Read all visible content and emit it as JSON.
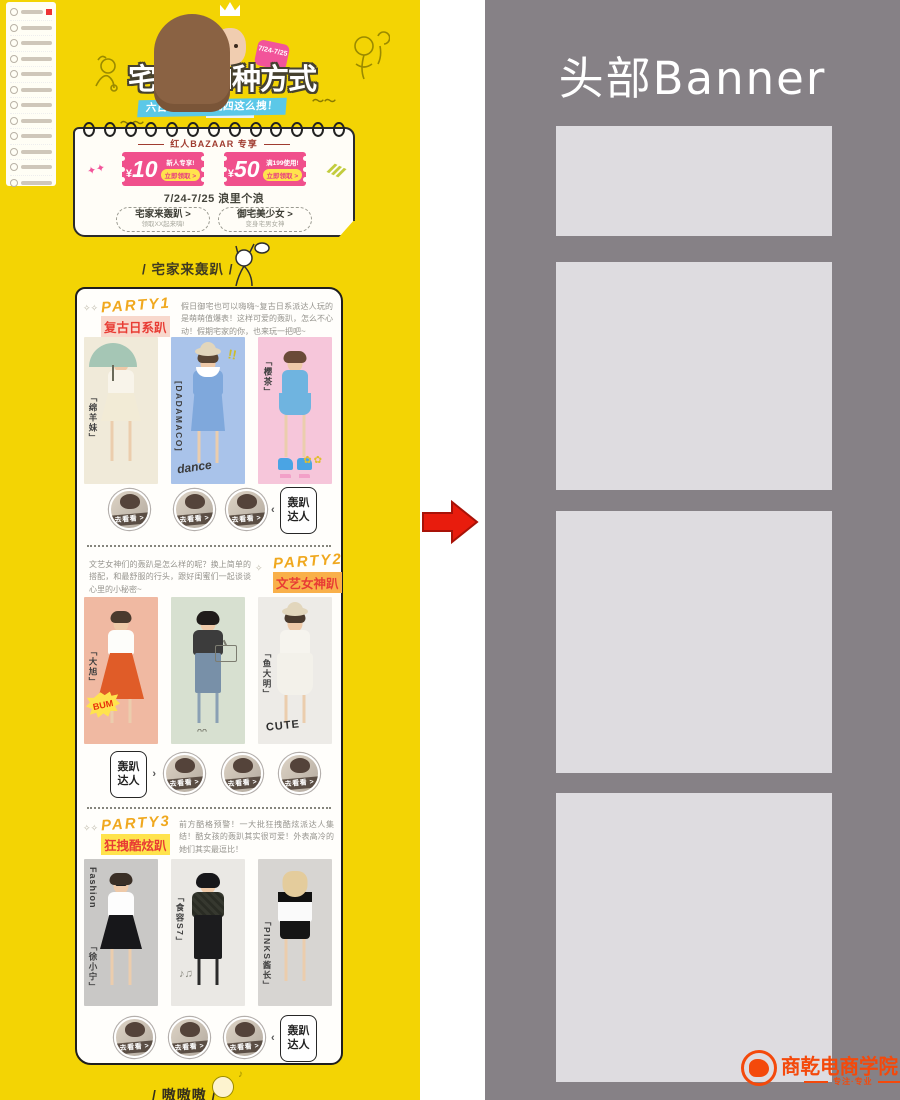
{
  "page": {
    "header": {
      "badge": "7/24-7/25",
      "title": "宅家のN种方式",
      "subtitle": "六日狂欢宅，就四这么拽！"
    },
    "coupon_panel": {
      "title": "红人BAZAAR 专享",
      "coupons": [
        {
          "currency": "¥",
          "amount": "10",
          "condition": "新人专享!",
          "action": "立即领取 >"
        },
        {
          "currency": "¥",
          "amount": "50",
          "condition": "满199使用!",
          "action": "立即领取 >"
        }
      ],
      "date_line": "7/24-7/25 浪里个浪",
      "nav_buttons": [
        {
          "label": "宅家来轰趴 >",
          "sub": "领取XX起来嗨!"
        },
        {
          "label": "御宅美少女 >",
          "sub": "变身宅男女神"
        }
      ]
    },
    "section_title": "/ 宅家来轰趴 /",
    "go_label": "去看看 >",
    "expert_label": "轰趴达人",
    "parties": [
      {
        "tag": "PARTY1",
        "name": "复古日系趴",
        "desc": "假日御宅也可以嗨嗨~复古日系派达人玩的是萌萌值爆表！这样可爱的轰趴，怎么不心动！假期宅家的你，也来玩一把吧~",
        "models": [
          {
            "label": "「绵羊妹」",
            "bg": "#f0ead9"
          },
          {
            "label": "[DADAMACO]",
            "bg": "#a9c3ea",
            "extra": "dance"
          },
          {
            "label": "「樱茶」",
            "bg": "#f6c6da"
          }
        ]
      },
      {
        "tag": "PARTY2",
        "name": "文艺女神趴",
        "desc": "文艺女神们的轰趴是怎么样的呢？换上简单的搭配，和最舒服的行头，跟好闺蜜们一起谈谈心里的小秘密~",
        "models": [
          {
            "label": "「大旭」",
            "bg": "#f0b9a2",
            "extra": "BUM"
          },
          {
            "label": "「蛋挞」",
            "bg": "#d7e0d0"
          },
          {
            "label": "「鱼大明」",
            "bg": "#edebe7",
            "extra": "CUTE"
          }
        ]
      },
      {
        "tag": "PARTY3",
        "name": "狂拽酷炫趴",
        "desc": "前方酷格预警！一大批狂拽酷炫派达人集结！酷女孩的轰趴其实很可爱！外表高冷的她们其实最逗比！",
        "models": [
          {
            "label": "「徐小宁」",
            "bg": "#c9c8c6",
            "extra": "Fashion"
          },
          {
            "label": "「食容S7」",
            "bg": "#eae8e4"
          },
          {
            "label": "「PINKS酱长」",
            "bg": "#d7d5d2"
          }
        ]
      }
    ],
    "next_section_title": "/ 嗷嗷嗷 /"
  },
  "wireframe": {
    "title": "头部Banner"
  },
  "watermark": {
    "name": "商乾电商学院",
    "tagline": "专注·专业"
  },
  "colors": {
    "page_yellow": "#f3d404",
    "panel_gray": "#868186",
    "placeholder_gray": "#dedce0",
    "coupon_pink": "#f0508c",
    "claim_yellow": "#ffe34d",
    "arrow_red": "#e81c0d",
    "accent_red": "#e83c34",
    "party_orange": "#f0a81e",
    "subtitle_blue": "#5bc8e8",
    "logo_orange": "#f4490b"
  }
}
